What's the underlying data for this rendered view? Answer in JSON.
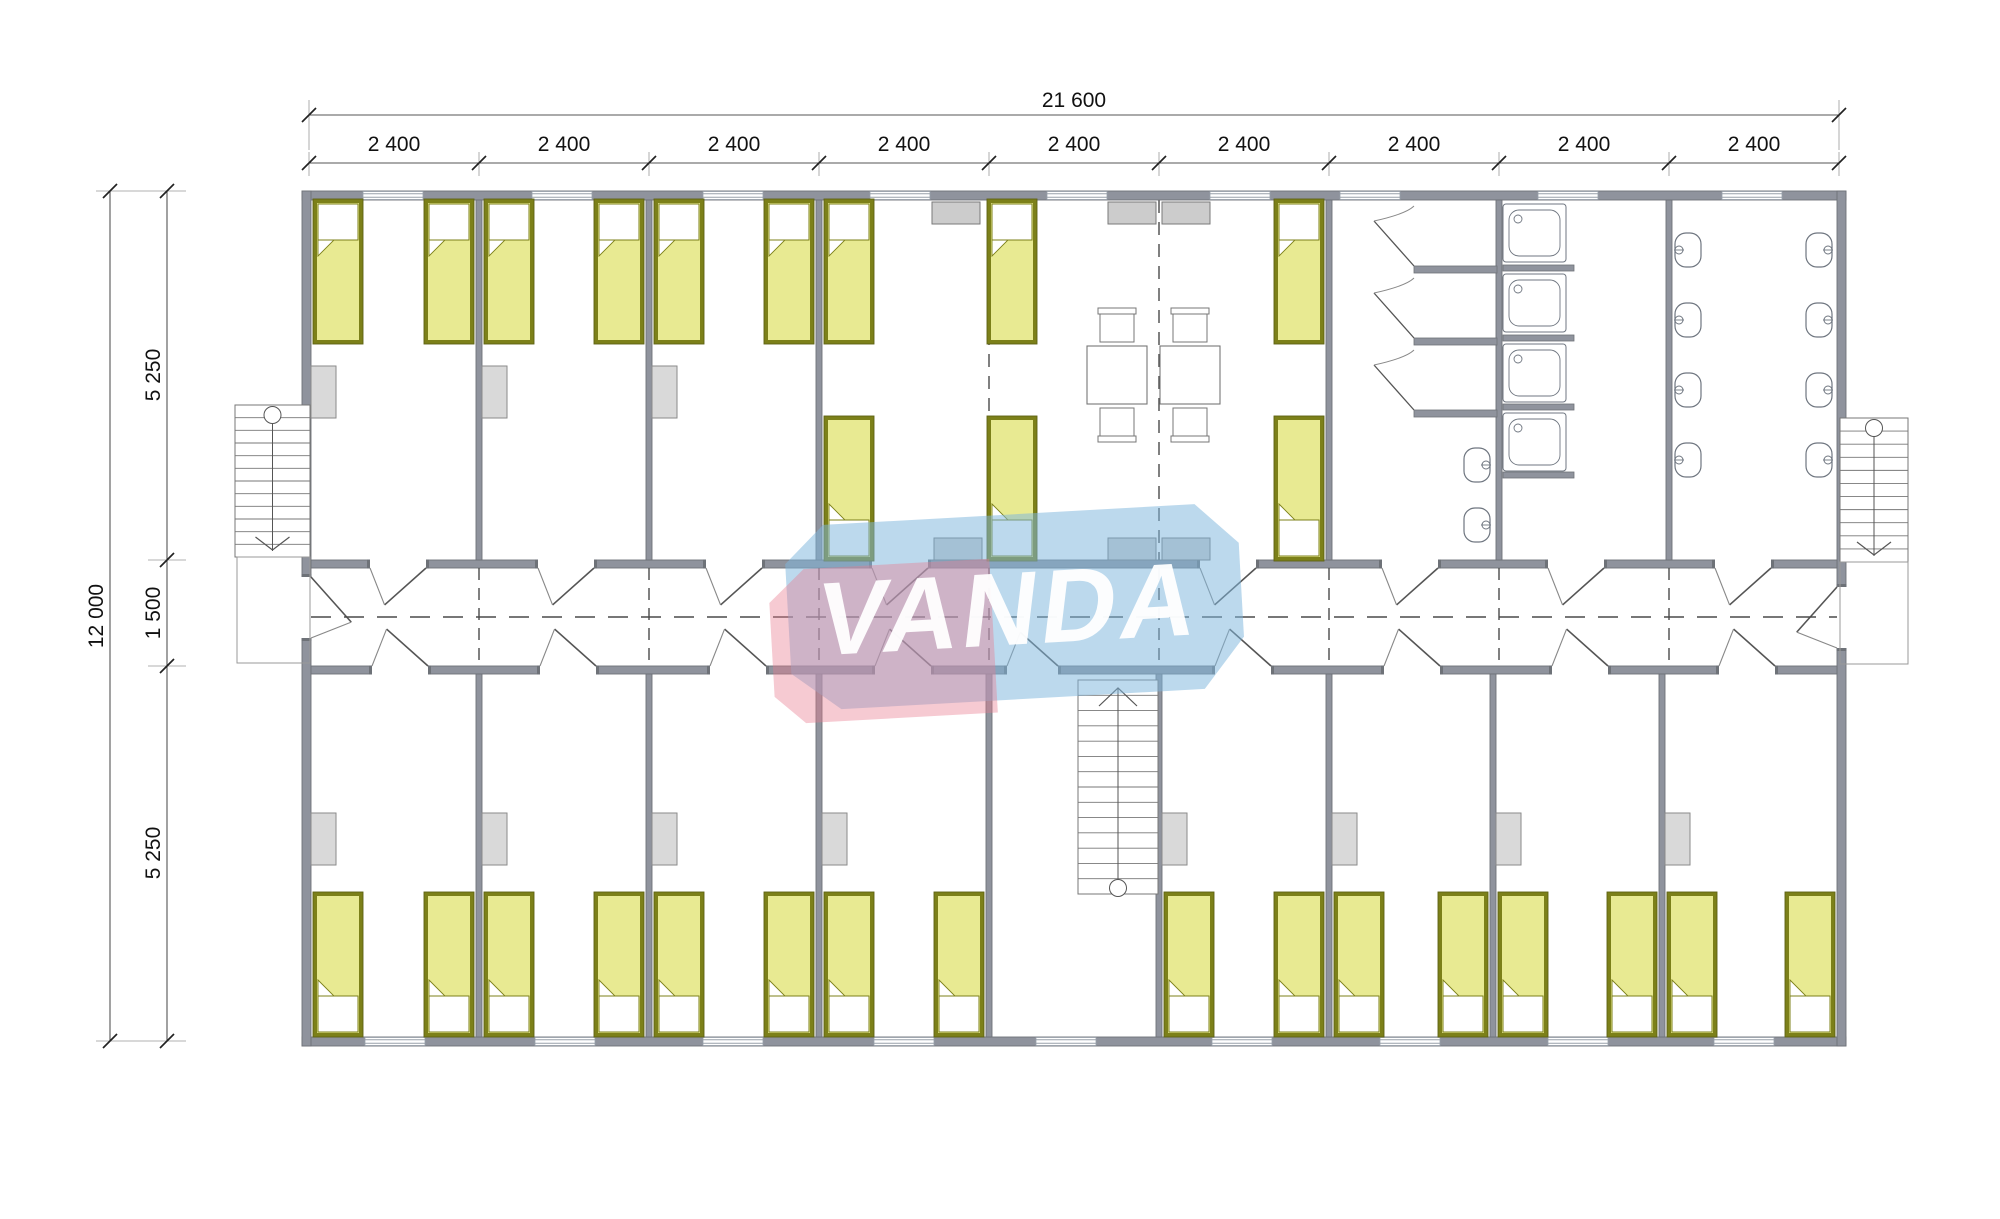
{
  "brand": {
    "name": "VANDA"
  },
  "colors": {
    "wall": "#8f939d",
    "wall_edge": "#6e7278",
    "floor": "#ffffff",
    "bed_frame": "#7c8019",
    "bed_frame_edge": "#5f6214",
    "bed_fill": "#e8ea92",
    "pillow": "#ffffff",
    "cabinet": "#d9d9d9",
    "cabinet_edge": "#8a8a8a",
    "counter": "#cccccc",
    "counter_edge": "#7a7a7a",
    "fixture": "#6f7680",
    "furniture_line": "#777777",
    "dash": "#4a4a4a",
    "dim_line": "#555555",
    "dim_tick": "#222222",
    "dim_text": "#111111",
    "ext_line": "#999999",
    "door_leaf": "#555555",
    "door_leaf2": "#888888",
    "window_line": "#98a0aa",
    "watermark_blue": "rgba(126,183,220,0.52)",
    "watermark_pink": "rgba(233,122,142,0.40)",
    "watermark_text": "rgba(255,255,255,0.95)"
  },
  "dimensions": {
    "total_width": {
      "text": "21 600",
      "x": 1074,
      "y": 107
    },
    "total_height": {
      "text": "12 000",
      "x": 103,
      "y": 616
    },
    "module_labels": [
      {
        "text": "2 400",
        "x": 394,
        "y": 151
      },
      {
        "text": "2 400",
        "x": 564,
        "y": 151
      },
      {
        "text": "2 400",
        "x": 734,
        "y": 151
      },
      {
        "text": "2 400",
        "x": 904,
        "y": 151
      },
      {
        "text": "2 400",
        "x": 1074,
        "y": 151
      },
      {
        "text": "2 400",
        "x": 1244,
        "y": 151
      },
      {
        "text": "2 400",
        "x": 1414,
        "y": 151
      },
      {
        "text": "2 400",
        "x": 1584,
        "y": 151
      },
      {
        "text": "2 400",
        "x": 1754,
        "y": 151
      }
    ],
    "height_segments": [
      {
        "text": "5 250",
        "x": 160,
        "y": 375
      },
      {
        "text": "1 500",
        "x": 160,
        "y": 613
      },
      {
        "text": "5 250",
        "x": 160,
        "y": 853
      }
    ]
  },
  "plan": {
    "module_ticks_x": [
      309,
      479,
      649,
      819,
      989,
      1159,
      1329,
      1499,
      1669,
      1839
    ],
    "dim_lines": {
      "top_total": {
        "x1": 309,
        "x2": 1839,
        "y": 115
      },
      "top_modules": {
        "x1": 309,
        "x2": 1839,
        "y": 163
      },
      "left_total": {
        "x": 110,
        "y1": 191,
        "y2": 1041
      },
      "left_inner": {
        "x": 167,
        "y1": 191,
        "y2": 1041,
        "ticks_y": [
          191,
          560,
          666,
          1041
        ]
      }
    },
    "walls": [
      {
        "x": 302,
        "y": 191,
        "w": 1544,
        "h": 9
      },
      {
        "x": 302,
        "y": 1037,
        "w": 1544,
        "h": 9
      },
      {
        "x": 302,
        "y": 191,
        "w": 9,
        "h": 855
      },
      {
        "x": 1837,
        "y": 191,
        "w": 9,
        "h": 855
      },
      {
        "x": 311,
        "y": 560,
        "w": 1526,
        "h": 8
      },
      {
        "x": 311,
        "y": 666,
        "w": 1526,
        "h": 8
      },
      {
        "x": 476,
        "y": 200,
        "w": 6,
        "h": 360
      },
      {
        "x": 646,
        "y": 200,
        "w": 6,
        "h": 360
      },
      {
        "x": 816,
        "y": 200,
        "w": 6,
        "h": 360
      },
      {
        "x": 1326,
        "y": 200,
        "w": 6,
        "h": 360
      },
      {
        "x": 1496,
        "y": 200,
        "w": 6,
        "h": 360
      },
      {
        "x": 1666,
        "y": 200,
        "w": 6,
        "h": 360
      },
      {
        "x": 476,
        "y": 674,
        "w": 6,
        "h": 363
      },
      {
        "x": 646,
        "y": 674,
        "w": 6,
        "h": 363
      },
      {
        "x": 816,
        "y": 674,
        "w": 6,
        "h": 363
      },
      {
        "x": 986,
        "y": 674,
        "w": 6,
        "h": 363
      },
      {
        "x": 1156,
        "y": 674,
        "w": 6,
        "h": 363
      },
      {
        "x": 1326,
        "y": 674,
        "w": 6,
        "h": 363
      },
      {
        "x": 1490,
        "y": 674,
        "w": 6,
        "h": 363
      },
      {
        "x": 1659,
        "y": 674,
        "w": 6,
        "h": 363
      }
    ],
    "windows_top_centers": [
      393,
      562,
      733,
      900,
      1077,
      1240,
      1370,
      1568,
      1752
    ],
    "windows_bottom_centers": [
      395,
      565,
      733,
      904,
      1066,
      1242,
      1410,
      1578,
      1744
    ],
    "window_w": 60,
    "beds": {
      "w": 50,
      "h": 145,
      "upper_head_top_x": [
        313,
        424,
        484,
        594,
        654,
        764,
        824,
        987,
        1274
      ],
      "upper_head_top_y": 199,
      "upper_head_bottom_x": [
        824,
        987,
        1274
      ],
      "upper_head_bottom_y": 416,
      "lower_x": [
        313,
        424,
        484,
        594,
        654,
        764,
        824,
        934,
        1164,
        1274,
        1334,
        1438,
        1498,
        1607,
        1667,
        1785
      ],
      "lower_y": 892
    },
    "wardrobes": {
      "w": 25,
      "h": 52,
      "upper_x": [
        311,
        482,
        652
      ],
      "upper_y": 366,
      "lower_x": [
        311,
        482,
        652,
        822,
        1162,
        1332,
        1496,
        1665
      ],
      "lower_y": 813
    },
    "counters": {
      "w": 48,
      "h": 22,
      "top_x": [
        932,
        1108,
        1162
      ],
      "top_y": 202,
      "bottom_x": [
        934,
        1108,
        1162
      ],
      "bottom_y": 538
    },
    "tables": [
      {
        "x": 1087,
        "y": 346,
        "w": 60,
        "h": 58
      },
      {
        "x": 1160,
        "y": 346,
        "w": 60,
        "h": 58
      }
    ],
    "chairs": [
      {
        "x": 1100,
        "y": 310,
        "back": "top"
      },
      {
        "x": 1173,
        "y": 310,
        "back": "top"
      },
      {
        "x": 1100,
        "y": 408,
        "back": "bottom"
      },
      {
        "x": 1173,
        "y": 408,
        "back": "bottom"
      }
    ],
    "doors_top_wall_x": [
      370,
      538,
      706,
      872,
      1200,
      1382,
      1548,
      1715
    ],
    "doors_bottom_wall_x": [
      372,
      540,
      710,
      875,
      1007,
      1215,
      1384,
      1552,
      1719
    ],
    "door_len": 56,
    "side_doors": [
      {
        "side": "west",
        "y": 577,
        "len": 61
      },
      {
        "side": "east",
        "y": 587,
        "len": 61
      }
    ],
    "joint_lines_rooms_x": [
      989,
      1159
    ],
    "joint_lines_corridor_x": [
      479,
      649,
      819,
      989,
      1159,
      1329,
      1499,
      1669
    ],
    "corridor_centerline_y": 617,
    "stairs": [
      {
        "name": "stair-left",
        "x": 235,
        "y": 405,
        "w": 75,
        "h": 152,
        "steps": 11,
        "circle": "top",
        "arrow": "down"
      },
      {
        "name": "stair-right",
        "x": 1840,
        "y": 418,
        "w": 68,
        "h": 144,
        "steps": 10,
        "circle": "top",
        "arrow": "down"
      },
      {
        "name": "stair-central",
        "x": 1078,
        "y": 680,
        "w": 80,
        "h": 214,
        "steps": 13,
        "circle": "bottom",
        "arrow": "up"
      }
    ],
    "landings": [
      {
        "x": 237,
        "y": 557,
        "w": 73,
        "h": 106
      },
      {
        "x": 1840,
        "y": 562,
        "w": 68,
        "h": 102
      }
    ],
    "wc_stalls": {
      "partitions_y": [
        266,
        338,
        410
      ],
      "x": 1414,
      "w": 83,
      "ph": 7
    },
    "shower_trays": {
      "x": 1503,
      "w": 63,
      "h": 58,
      "ys": [
        204,
        274,
        344,
        413
      ],
      "partitions_y": [
        265,
        335,
        404,
        472
      ],
      "pw": 71,
      "ph": 6
    },
    "basins": [
      {
        "x": 1464,
        "y": 448,
        "tap": "right"
      },
      {
        "x": 1464,
        "y": 508,
        "tap": "right"
      },
      {
        "x": 1675,
        "y": 233,
        "tap": "left"
      },
      {
        "x": 1675,
        "y": 303,
        "tap": "left"
      },
      {
        "x": 1675,
        "y": 373,
        "tap": "left"
      },
      {
        "x": 1675,
        "y": 443,
        "tap": "left"
      },
      {
        "x": 1806,
        "y": 233,
        "tap": "right"
      },
      {
        "x": 1806,
        "y": 303,
        "tap": "right"
      },
      {
        "x": 1806,
        "y": 373,
        "tap": "right"
      },
      {
        "x": 1806,
        "y": 443,
        "tap": "right"
      }
    ],
    "watermark": {
      "rotate": -3.2,
      "cx": 1003,
      "cy": 608,
      "blue_points": "828,515 1200,515 1242,556 1242,650 1200,700 836,700 788,662 788,552",
      "pink_points": "806,558 992,558 992,712 800,712 770,684 770,590",
      "text_x": 1003,
      "text_y": 645,
      "font_size": 104
    }
  }
}
